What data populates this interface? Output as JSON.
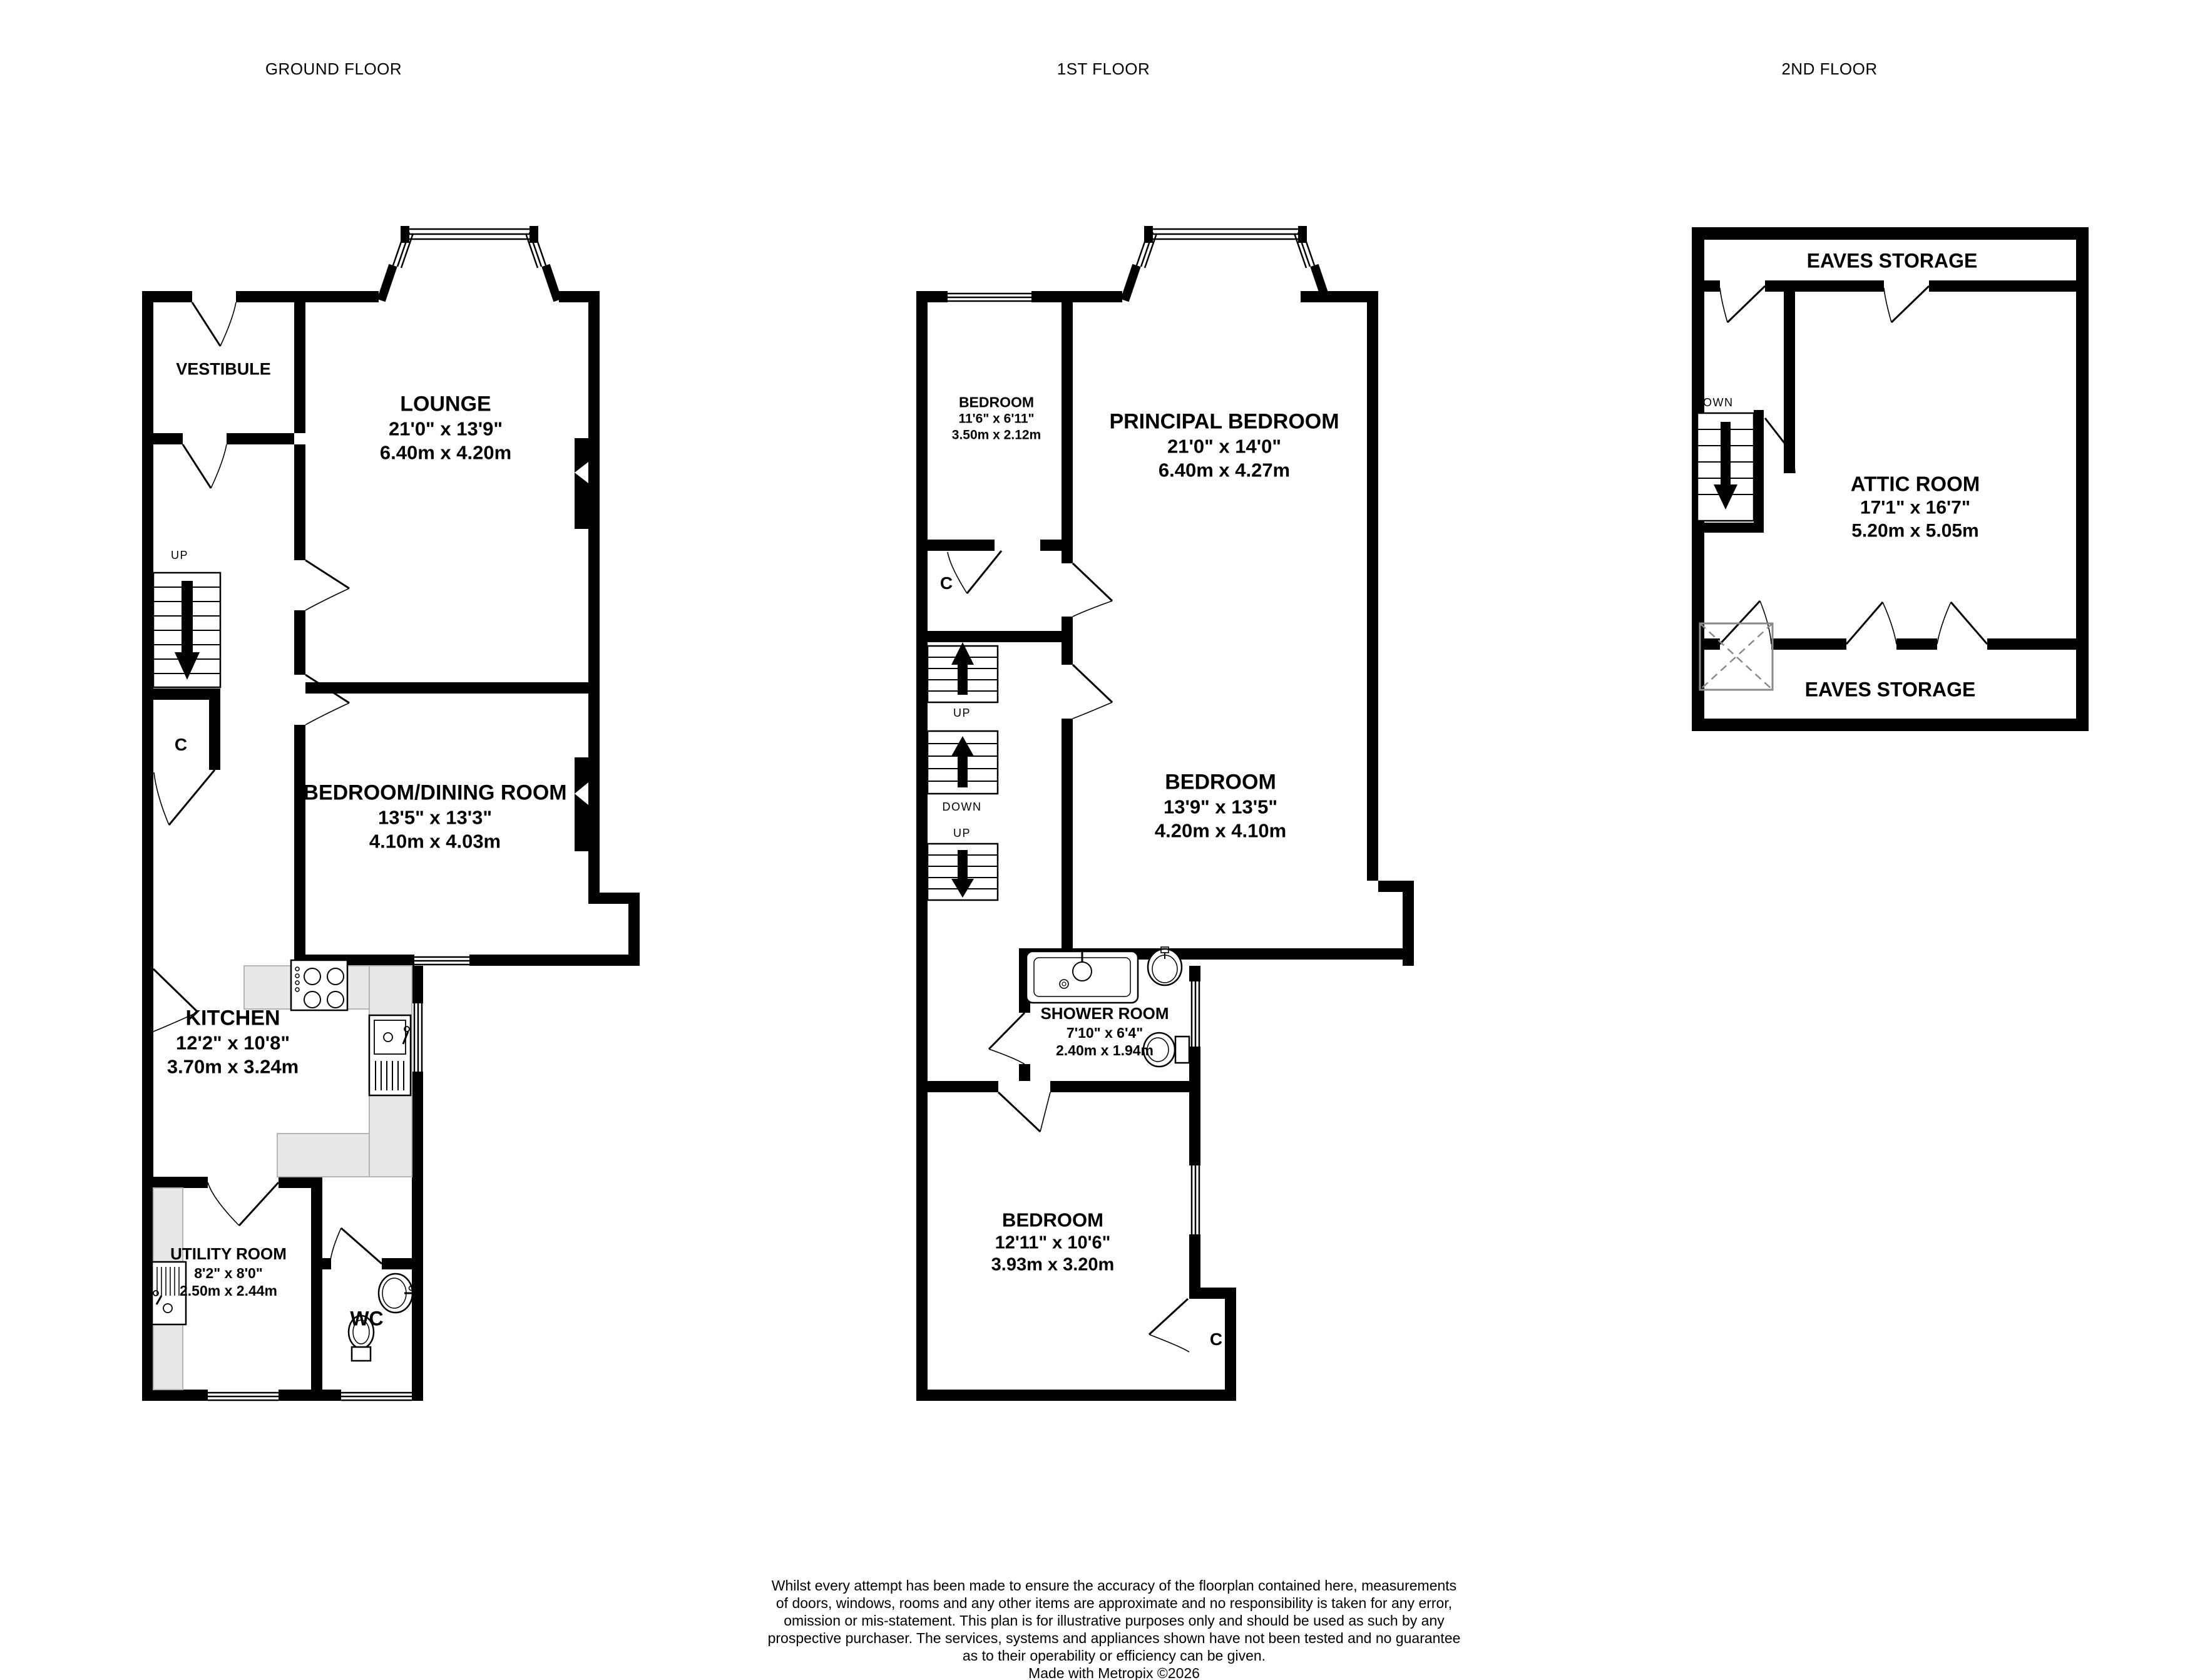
{
  "floor_labels": {
    "ground": "GROUND FLOOR",
    "first": "1ST FLOOR",
    "second": "2ND FLOOR"
  },
  "colors": {
    "wall": "#000000",
    "counter": "#e8e8e8",
    "counter_edge": "#b5b5b5",
    "hatch": "#8a8a8a"
  },
  "ground": {
    "vestibule": {
      "name": "VESTIBULE"
    },
    "lounge": {
      "name": "LOUNGE",
      "imperial": "21'0\"  x 13'9\"",
      "metric": "6.40m  x 4.20m"
    },
    "bedroom_dining": {
      "name": "BEDROOM/DINING ROOM",
      "imperial": "13'5\"  x 13'3\"",
      "metric": "4.10m  x 4.03m"
    },
    "kitchen": {
      "name": "KITCHEN",
      "imperial": "12'2\"  x 10'8\"",
      "metric": "3.70m  x 3.24m"
    },
    "utility": {
      "name": "UTILITY ROOM",
      "imperial": "8'2\"  x 8'0\"",
      "metric": "2.50m  x 2.44m"
    },
    "wc": {
      "name": "WC"
    },
    "closet": "C",
    "stairs_up": "UP"
  },
  "first": {
    "bedroom_small": {
      "name": "BEDROOM",
      "imperial": "11'6\"  x 6'11\"",
      "metric": "3.50m  x 2.12m"
    },
    "principal_bedroom": {
      "name": "PRINCIPAL BEDROOM",
      "imperial": "21'0\"  x 14'0\"",
      "metric": "6.40m  x 4.27m"
    },
    "bedroom_middle": {
      "name": "BEDROOM",
      "imperial": "13'9\"  x 13'5\"",
      "metric": "4.20m  x 4.10m"
    },
    "shower_room": {
      "name": "SHOWER ROOM",
      "imperial": "7'10\"  x 6'4\"",
      "metric": "2.40m  x 1.94m"
    },
    "bedroom_rear": {
      "name": "BEDROOM",
      "imperial": "12'11\"  x 10'6\"",
      "metric": "3.93m  x 3.20m"
    },
    "closet_upper": "C",
    "closet_lower": "C",
    "stairs": {
      "up_upper": "UP",
      "down": "DOWN",
      "up_lower": "UP"
    }
  },
  "second": {
    "eaves_front": "EAVES STORAGE",
    "attic": {
      "name": "ATTIC ROOM",
      "imperial": "17'1\"  x 16'7\"",
      "metric": "5.20m  x 5.05m"
    },
    "eaves_rear": "EAVES STORAGE",
    "stairs_down": "DOWN"
  },
  "footer": {
    "lines": [
      "Whilst every attempt has been made to ensure the accuracy of the floorplan contained here, measurements",
      "of doors, windows, rooms and any other items are approximate and no responsibility is taken for any error,",
      "omission or mis-statement. This plan is for illustrative purposes only and should be used as such by any",
      "prospective purchaser. The services, systems and appliances shown have not been tested and no guarantee",
      "as to their operability or efficiency can be given."
    ],
    "credit": "Made with Metropix ©2026"
  }
}
